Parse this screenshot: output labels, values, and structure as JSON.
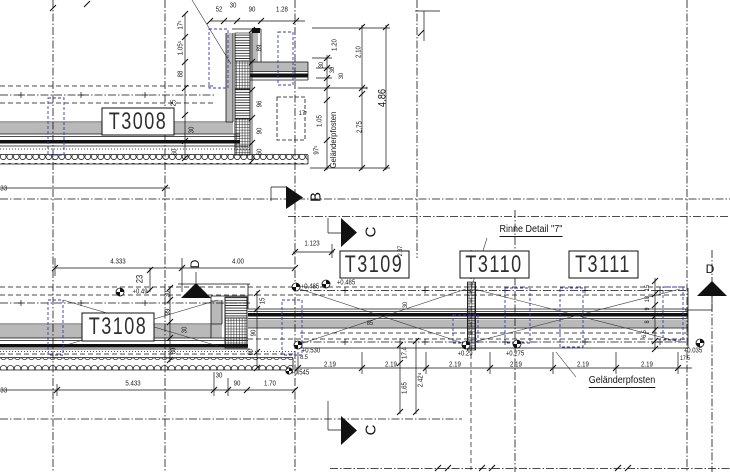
{
  "drawing_type": "architectural-detail-plan",
  "colors": {
    "line": "#111111",
    "gray_fill": "#b9b9b9",
    "post_blue": "#3a3ab8",
    "background": "#ffffff"
  },
  "component_labels": [
    {
      "id": "t3008",
      "text": "T3008",
      "x": 138,
      "y": 121.5
    },
    {
      "id": "t3108",
      "text": "T3108",
      "x": 118,
      "y": 327
    },
    {
      "id": "t3109",
      "text": "T3109",
      "x": 374,
      "y": 264.5
    },
    {
      "id": "t3110",
      "text": "T3110",
      "x": 494,
      "y": 264.5
    },
    {
      "id": "t3111",
      "text": "T3111",
      "x": 603,
      "y": 264.5
    }
  ],
  "annotations": [
    {
      "id": "rinne-detail",
      "text": "Rinne Detail \"7\"",
      "x": 531,
      "y": 231,
      "s": 10,
      "u": true
    },
    {
      "id": "gelaenderpfosten-vertical",
      "text": "Geländerpfosten",
      "x": 333,
      "y": 140,
      "s": 8.5,
      "rot": -90
    },
    {
      "id": "gelaenderpfosten-bottom",
      "text": "Geländerpfosten",
      "x": 622,
      "y": 382,
      "s": 10,
      "u": true
    }
  ],
  "section_markers": [
    {
      "id": "b",
      "letter": "B",
      "x": 316,
      "y": 197,
      "rot": -90,
      "s": 15
    },
    {
      "id": "c-upper",
      "letter": "C",
      "x": 371,
      "y": 232,
      "rot": -90,
      "s": 15
    },
    {
      "id": "c-lower",
      "letter": "C",
      "x": 371,
      "y": 430,
      "rot": -90,
      "s": 15
    },
    {
      "id": "d-left",
      "letter": "D",
      "x": 195,
      "y": 264,
      "rot": -90,
      "s": 12
    },
    {
      "id": "d-right",
      "letter": "D",
      "x": 710,
      "y": 269,
      "rot": 0,
      "s": 12
    }
  ],
  "elevation_labels": [
    {
      "t": "+0.49",
      "x": 140,
      "y": 292
    },
    {
      "t": "+0.485",
      "x": 310,
      "y": 287
    },
    {
      "t": "+0.485",
      "x": 346,
      "y": 283
    },
    {
      "t": "+0.530",
      "x": 311,
      "y": 351
    },
    {
      "t": "8.5",
      "x": 304,
      "y": 358,
      "s": 6.5
    },
    {
      "t": "+0.545",
      "x": 300,
      "y": 373
    },
    {
      "t": "+0.29",
      "x": 465,
      "y": 354
    },
    {
      "t": "+0.275",
      "x": 515,
      "y": 354
    },
    {
      "t": "+0.035",
      "x": 693,
      "y": 351
    },
    {
      "t": "17.5",
      "x": 685,
      "y": 359,
      "s": 6
    }
  ],
  "dimensions": [
    {
      "t": "52",
      "x": 219,
      "y": 9
    },
    {
      "t": "30",
      "x": 233,
      "y": 5
    },
    {
      "t": "90",
      "x": 252,
      "y": 9
    },
    {
      "t": "1.28",
      "x": 282,
      "y": 9
    },
    {
      "t": "17⁵",
      "x": 180,
      "y": 25,
      "rot": -90
    },
    {
      "t": "1.05⁵",
      "x": 180,
      "y": 48,
      "rot": -90
    },
    {
      "t": "88",
      "x": 180,
      "y": 74,
      "rot": -90
    },
    {
      "t": "25",
      "x": 173,
      "y": 103,
      "rot": -90
    },
    {
      "t": "30",
      "x": 191,
      "y": 130,
      "rot": -90
    },
    {
      "t": "60",
      "x": 174,
      "y": 152,
      "rot": -90
    },
    {
      "t": "89",
      "x": 259,
      "y": 48,
      "rot": -90
    },
    {
      "t": "96",
      "x": 259,
      "y": 104,
      "rot": -90
    },
    {
      "t": "90",
      "x": 259,
      "y": 131,
      "rot": -90
    },
    {
      "t": "60",
      "x": 259,
      "y": 152,
      "rot": -90
    },
    {
      "t": "17⁵",
      "x": 303,
      "y": 114,
      "s": 6.5
    },
    {
      "t": "1.20",
      "x": 334,
      "y": 45,
      "rot": -90
    },
    {
      "t": "30",
      "x": 322,
      "y": 65,
      "rot": -90,
      "s": 6.5
    },
    {
      "t": "30",
      "x": 333,
      "y": 70,
      "rot": -90,
      "s": 6.5
    },
    {
      "t": "30",
      "x": 342,
      "y": 76,
      "rot": -90,
      "s": 6.5
    },
    {
      "t": "2.10",
      "x": 358,
      "y": 52,
      "rot": -90
    },
    {
      "t": "1",
      "x": 364,
      "y": 88,
      "rot": -90
    },
    {
      "t": "2.75",
      "x": 359,
      "y": 127,
      "rot": -90
    },
    {
      "t": "4.86",
      "x": 383,
      "y": 98,
      "rot": -90,
      "s": 11
    },
    {
      "t": "1.05",
      "x": 319,
      "y": 121,
      "rot": -90
    },
    {
      "t": "97⁵",
      "x": 316,
      "y": 150,
      "rot": -90
    },
    {
      "t": "4.333",
      "x": 118,
      "y": 261
    },
    {
      "t": "4.00",
      "x": 238,
      "y": 261
    },
    {
      "t": "1.123",
      "x": 312,
      "y": 243
    },
    {
      "t": "23",
      "x": 140,
      "y": 279,
      "rot": -90,
      "s": 9
    },
    {
      "t": "30",
      "x": 167,
      "y": 294,
      "rot": -90
    },
    {
      "t": "99",
      "x": 167,
      "y": 312,
      "rot": -90
    },
    {
      "t": "30",
      "x": 184,
      "y": 330,
      "rot": -90
    },
    {
      "t": "60",
      "x": 173,
      "y": 351,
      "rot": -90
    },
    {
      "t": "15",
      "x": 262,
      "y": 301,
      "rot": -90
    },
    {
      "t": "90",
      "x": 253,
      "y": 333,
      "rot": -90
    },
    {
      "t": "60",
      "x": 250,
      "y": 352,
      "rot": -90
    },
    {
      "t": "85",
      "x": 370,
      "y": 324,
      "s": 6.5
    },
    {
      "t": "30",
      "x": 406,
      "y": 305,
      "rot": -90,
      "s": 6.5
    },
    {
      "t": "2.37",
      "x": 401,
      "y": 251,
      "rot": -90,
      "s": 6.5
    },
    {
      "t": "2.19",
      "x": 330,
      "y": 364
    },
    {
      "t": "2.19",
      "x": 391,
      "y": 364
    },
    {
      "t": "2.19",
      "x": 455,
      "y": 364
    },
    {
      "t": "2.19",
      "x": 516,
      "y": 364
    },
    {
      "t": "2.19",
      "x": 583,
      "y": 364
    },
    {
      "t": "2.19",
      "x": 647,
      "y": 364
    },
    {
      "t": "17.4",
      "x": 404,
      "y": 353,
      "rot": -90
    },
    {
      "t": "1.65",
      "x": 404,
      "y": 388,
      "rot": -90
    },
    {
      "t": "2.42⁴",
      "x": 420,
      "y": 380,
      "rot": -90
    },
    {
      "t": "15",
      "x": 648,
      "y": 288,
      "rot": -90,
      "s": 6.5
    },
    {
      "t": "10",
      "x": 648,
      "y": 299,
      "rot": -90,
      "s": 6.5
    },
    {
      "t": "9",
      "x": 648,
      "y": 309,
      "rot": -90,
      "s": 6.5
    },
    {
      "t": "8",
      "x": 648,
      "y": 322,
      "rot": -90,
      "s": 6.5
    },
    {
      "t": "6.5",
      "x": 645,
      "y": 334,
      "rot": -90,
      "s": 6.5
    },
    {
      "t": "5.433",
      "x": 133,
      "y": 383
    },
    {
      "t": "30",
      "x": 219,
      "y": 375
    },
    {
      "t": "90",
      "x": 237,
      "y": 383
    },
    {
      "t": "1.70",
      "x": 270,
      "y": 383
    }
  ],
  "fragments": [
    {
      "t": "433",
      "x": 2,
      "y": 188
    },
    {
      "t": "433",
      "x": 2,
      "y": 390
    }
  ]
}
